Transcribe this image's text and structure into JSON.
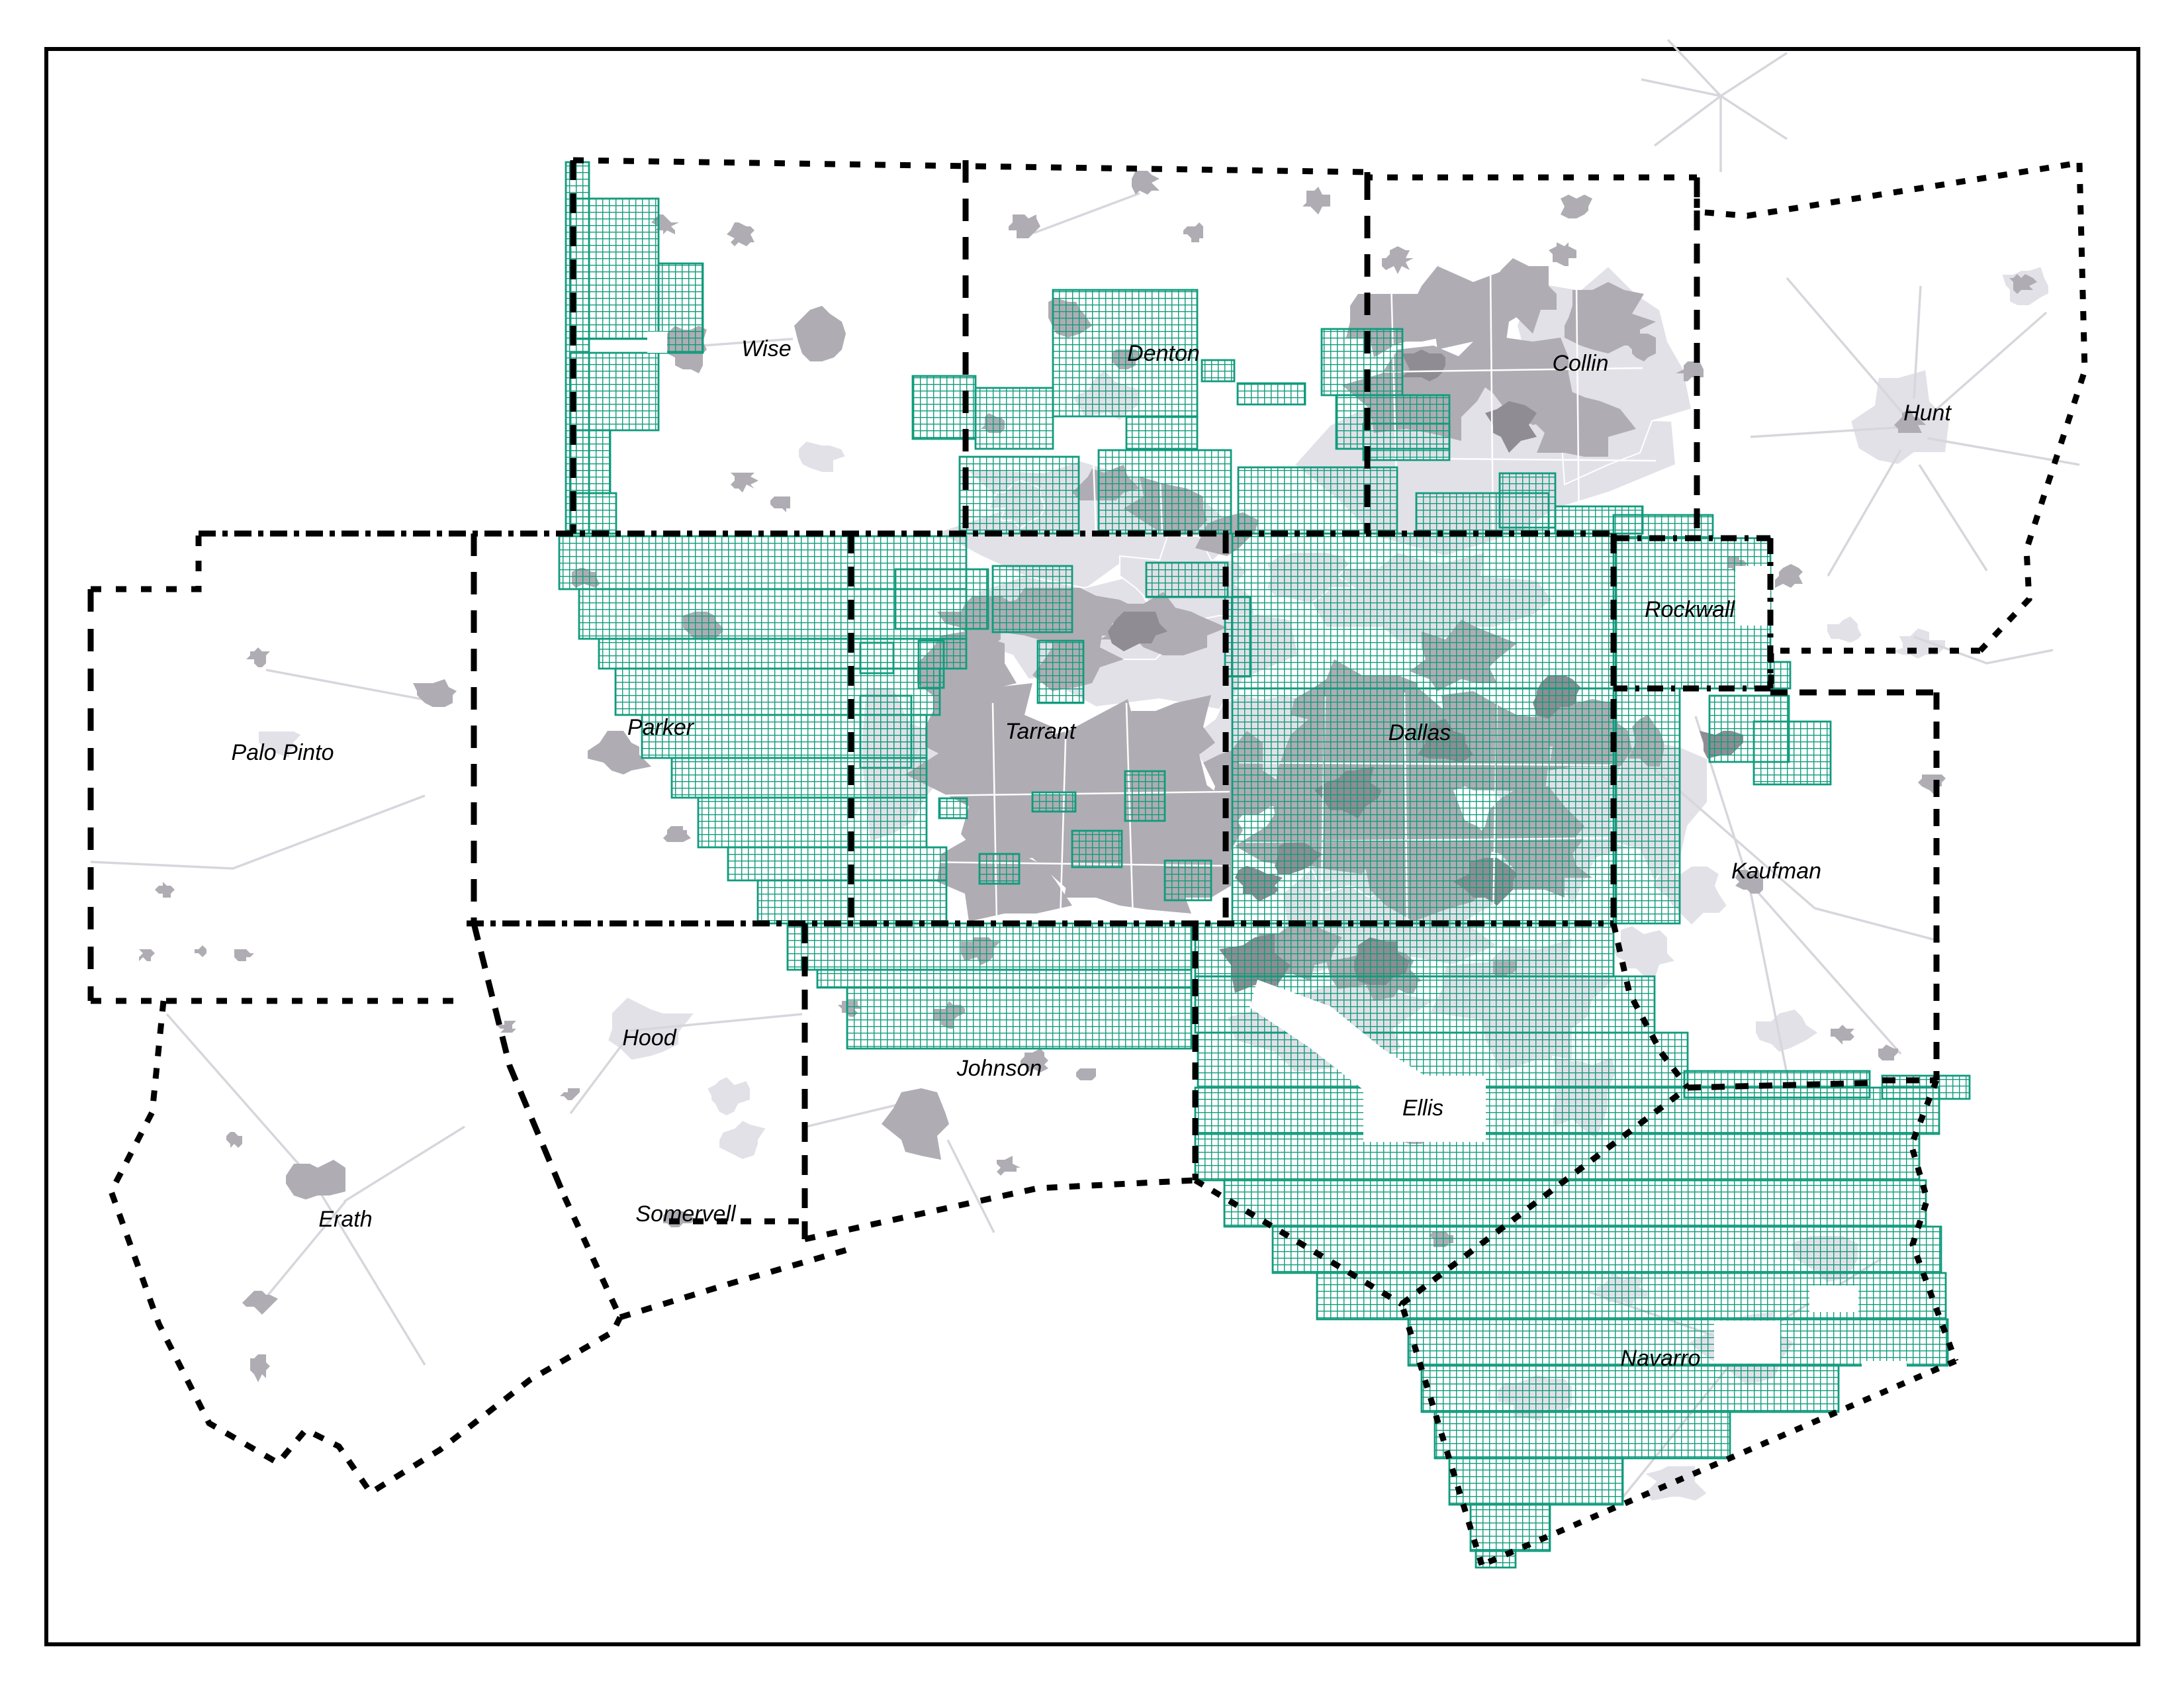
{
  "map": {
    "description": "Dallas–Fort Worth regional county map with teal gridded coverage area, urban areas in gray, dashed county boundaries",
    "background": "#ffffff"
  },
  "colors": {
    "grid_line": "#109b7d",
    "urban_light": "#e3e1e8",
    "urban_medium": "#afadb3",
    "urban_dark": "#8f8d93",
    "road_light": "#d8d6dc",
    "boundary": "#000000",
    "frame": "#000000"
  },
  "counties": [
    {
      "name": "Wise"
    },
    {
      "name": "Denton"
    },
    {
      "name": "Collin"
    },
    {
      "name": "Hunt"
    },
    {
      "name": "Palo Pinto"
    },
    {
      "name": "Parker"
    },
    {
      "name": "Tarrant"
    },
    {
      "name": "Dallas"
    },
    {
      "name": "Rockwall"
    },
    {
      "name": "Kaufman"
    },
    {
      "name": "Hood"
    },
    {
      "name": "Johnson"
    },
    {
      "name": "Ellis"
    },
    {
      "name": "Erath"
    },
    {
      "name": "Somervell"
    },
    {
      "name": "Navarro"
    }
  ]
}
